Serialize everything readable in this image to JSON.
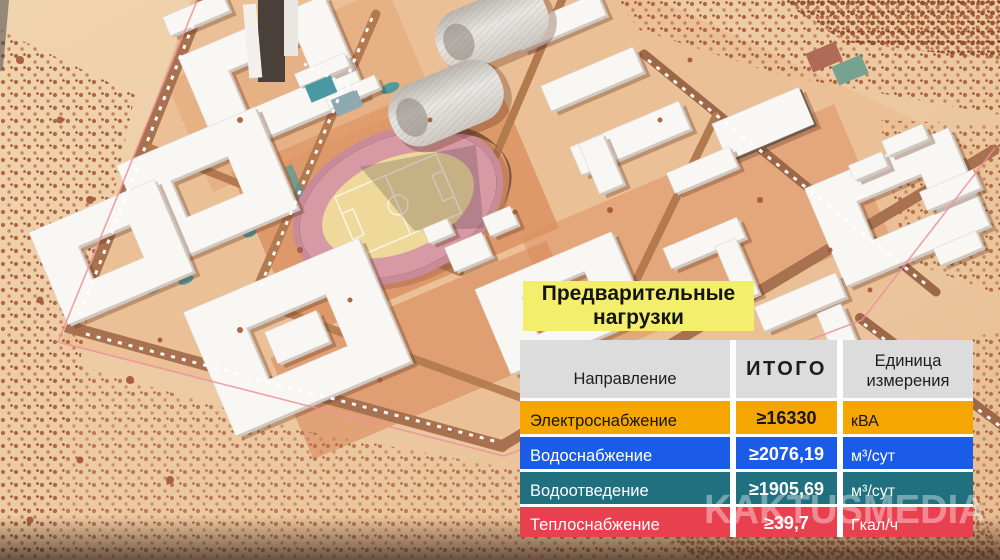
{
  "overlay": {
    "title": "Предварительные нагрузки",
    "table": {
      "columns": [
        "Направление",
        "ИТОГО",
        "Единица измерения"
      ],
      "rows": [
        {
          "name": "Электроснабжение",
          "total": "≥16330",
          "unit": "кВА",
          "color": "#f5a600",
          "text": "#161616"
        },
        {
          "name": "Водоснабжение",
          "total": "≥2076,19",
          "unit": "м³/сут",
          "color": "#1a5be8",
          "text": "#ffffff"
        },
        {
          "name": "Водоотведение",
          "total": "≥1905,69",
          "unit": "м³/сут",
          "color": "#20707f",
          "text": "#ffffff"
        },
        {
          "name": "Теплоснабжение",
          "total": "≥39,7",
          "unit": "Гкал/ч",
          "color": "#e9404f",
          "text": "#ffffff"
        }
      ]
    }
  },
  "watermark": "KAKTUSMEDIA",
  "colors": {
    "title_bg": "#f3ef6d",
    "header_bg": "#dcdcdc",
    "gap": "#ffffff",
    "scene_sand": "#ecc9a1",
    "scene_campus": "#ebc096",
    "scene_track_pink": "#cf8e9a",
    "scene_pitch_yellow": "#eed99b",
    "scene_pool_teal": "#3f9aa0"
  },
  "chart_data": {
    "type": "table",
    "title": "Предварительные нагрузки",
    "columns": [
      "Направление",
      "ИТОГО",
      "Единица измерения"
    ],
    "rows": [
      [
        "Электроснабжение",
        "≥16330",
        "кВА"
      ],
      [
        "Водоснабжение",
        "≥2076,19",
        "м³/сут"
      ],
      [
        "Водоотведение",
        "≥1905,69",
        "м³/сут"
      ],
      [
        "Теплоснабжение",
        "≥39,7",
        "Гкал/ч"
      ]
    ],
    "row_colors": [
      "#f5a600",
      "#1a5be8",
      "#20707f",
      "#e9404f"
    ]
  }
}
